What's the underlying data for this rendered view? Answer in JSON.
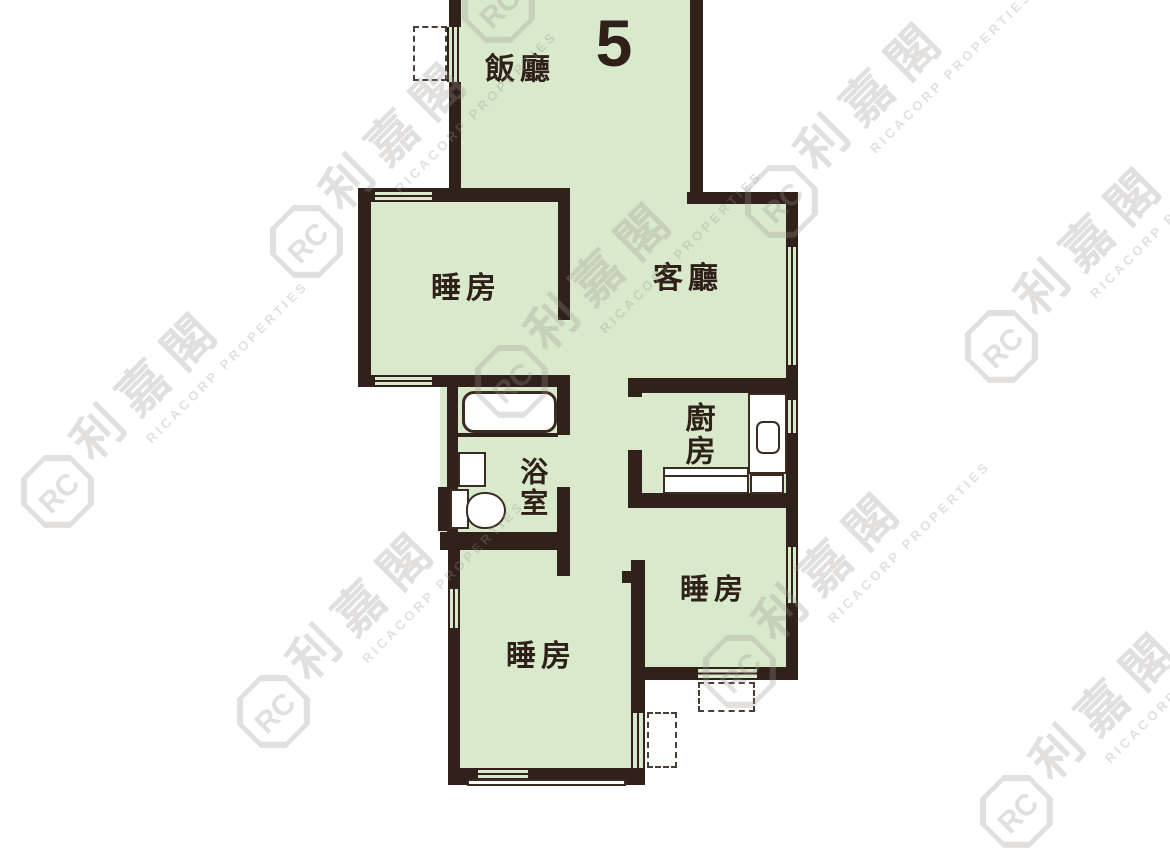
{
  "unit": {
    "number": "5"
  },
  "rooms": {
    "dining": {
      "label": "飯廳"
    },
    "living": {
      "label": "客廳"
    },
    "bedroom1": {
      "label": "睡房"
    },
    "bedroom2": {
      "label": "睡房"
    },
    "bedroom3": {
      "label": "睡房"
    },
    "kitchen": {
      "label": "廚房"
    },
    "bathroom": {
      "label": "浴室"
    }
  },
  "watermark": {
    "logo_monogram": "RC",
    "brand_cjk": "利嘉閣",
    "brand_latin": "RICACORP PROPERTIES"
  },
  "fixtures": [
    "bathtub",
    "toilet",
    "wash-basin",
    "kitchen-sink",
    "kitchen-counter",
    "stove",
    "window",
    "ac-platform",
    "bay-window"
  ],
  "palette": {
    "bg": "#ffffff",
    "wall": "#30221a",
    "floor": "#d9e9cb",
    "outline": "#3a2c22",
    "dashed": "#4a3f38",
    "label": "#2f2119",
    "watermark": "#9b918c"
  }
}
